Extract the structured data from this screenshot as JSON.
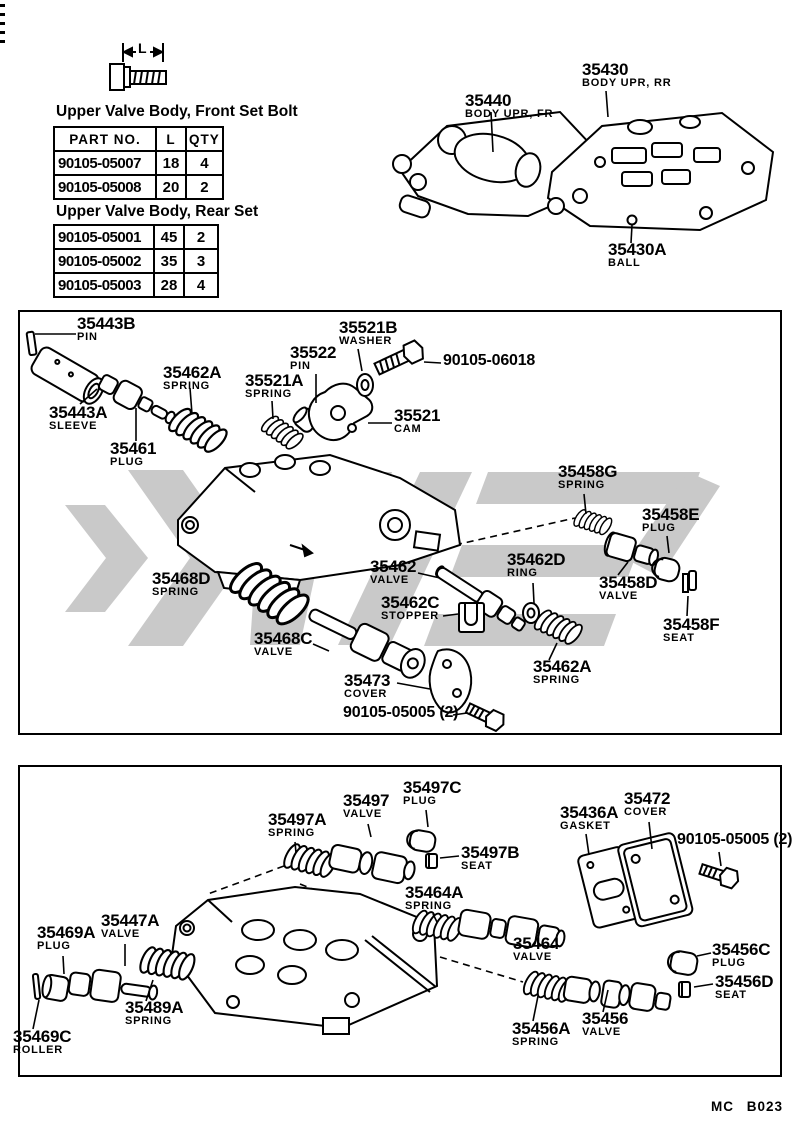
{
  "colors": {
    "line": "#000000",
    "background": "#ffffff",
    "watermark": "#c9c9c9"
  },
  "page": {
    "footer_code": "MC B023"
  },
  "bolt_diagram": {
    "dim_label": "L"
  },
  "tables": {
    "front": {
      "title": "Upper Valve Body, Front Set Bolt",
      "headers": [
        "PART NO.",
        "L",
        "QTY"
      ],
      "rows": [
        [
          "90105-05007",
          "18",
          "4"
        ],
        [
          "90105-05008",
          "20",
          "2"
        ]
      ]
    },
    "rear": {
      "title": "Upper Valve Body, Rear Set",
      "rows": [
        [
          "90105-05001",
          "45",
          "2"
        ],
        [
          "90105-05002",
          "35",
          "3"
        ],
        [
          "90105-05003",
          "28",
          "4"
        ]
      ]
    }
  },
  "top_assembly": {
    "labels": [
      {
        "part": "35440",
        "name": "BODY UPR, FR"
      },
      {
        "part": "35430",
        "name": "BODY UPR, RR"
      },
      {
        "part": "35430A",
        "name": "BALL"
      }
    ]
  },
  "upper_section": {
    "labels": [
      {
        "part": "35443B",
        "name": "PIN"
      },
      {
        "part": "35443A",
        "name": "SLEEVE"
      },
      {
        "part": "35461",
        "name": "PLUG"
      },
      {
        "part": "35462A",
        "name": "SPRING"
      },
      {
        "part": "35521A",
        "name": "SPRING"
      },
      {
        "part": "35522",
        "name": "PIN"
      },
      {
        "part": "35521B",
        "name": "WASHER"
      },
      {
        "part": "90105-06018",
        "name": ""
      },
      {
        "part": "35521",
        "name": "CAM"
      },
      {
        "part": "35458G",
        "name": "SPRING"
      },
      {
        "part": "35458E",
        "name": "PLUG"
      },
      {
        "part": "35462",
        "name": "VALVE"
      },
      {
        "part": "35462D",
        "name": "RING"
      },
      {
        "part": "35458D",
        "name": "VALVE"
      },
      {
        "part": "35468D",
        "name": "SPRING"
      },
      {
        "part": "35462C",
        "name": "STOPPER"
      },
      {
        "part": "35458F",
        "name": "SEAT"
      },
      {
        "part": "35468C",
        "name": "VALVE"
      },
      {
        "part": "35473",
        "name": "COVER"
      },
      {
        "part": "35462A",
        "name": "SPRING"
      },
      {
        "part": "90105-05005 (2)",
        "name": ""
      }
    ]
  },
  "lower_section": {
    "labels": [
      {
        "part": "35497C",
        "name": "PLUG"
      },
      {
        "part": "35497",
        "name": "VALVE"
      },
      {
        "part": "35497A",
        "name": "SPRING"
      },
      {
        "part": "35497B",
        "name": "SEAT"
      },
      {
        "part": "35436A",
        "name": "GASKET"
      },
      {
        "part": "35472",
        "name": "COVER"
      },
      {
        "part": "90105-05005 (2)",
        "name": ""
      },
      {
        "part": "35464A",
        "name": "SPRING"
      },
      {
        "part": "35447A",
        "name": "VALVE"
      },
      {
        "part": "35469A",
        "name": "PLUG"
      },
      {
        "part": "35464",
        "name": "VALVE"
      },
      {
        "part": "35456C",
        "name": "PLUG"
      },
      {
        "part": "35456D",
        "name": "SEAT"
      },
      {
        "part": "35489A",
        "name": "SPRING"
      },
      {
        "part": "35456A",
        "name": "SPRING"
      },
      {
        "part": "35456",
        "name": "VALVE"
      },
      {
        "part": "35469C",
        "name": "ROLLER"
      }
    ]
  }
}
